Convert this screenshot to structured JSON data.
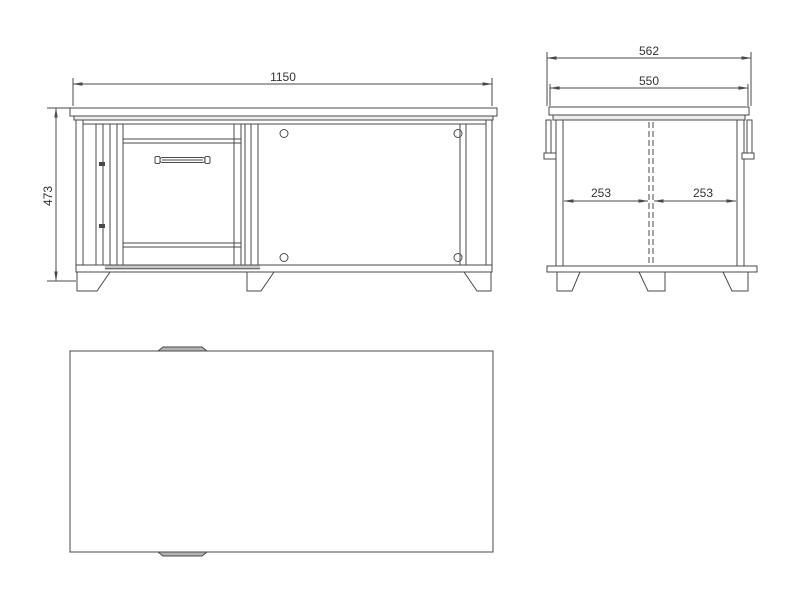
{
  "colors": {
    "line": "#4a4a4a",
    "text": "#333333",
    "background": "#ffffff",
    "light_band": "#ededed",
    "shaded_strip": "#c9c9c9",
    "tab_fill": "#b3b3b3",
    "white": "#ffffff"
  },
  "views": {
    "front": {
      "dim_width": "1150",
      "dim_height": "473"
    },
    "side": {
      "dim_overall_depth": "562",
      "dim_top_depth": "550",
      "dim_half_left": "253",
      "dim_half_right": "253"
    }
  }
}
